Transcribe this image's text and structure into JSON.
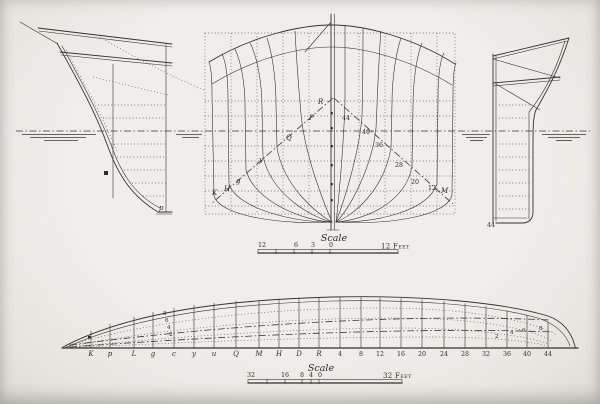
{
  "colors": {
    "paper": "#efeeea",
    "ink": "#35322c"
  },
  "body_plan": {
    "left_labels": [
      "R",
      "P",
      "Q",
      "y",
      "g",
      "H",
      "K"
    ],
    "right_labels": [
      "44",
      "40",
      "36",
      "28",
      "20",
      "12",
      "M"
    ]
  },
  "bow_profile": {
    "station_label": "p"
  },
  "stern_profile": {
    "station_label": "44"
  },
  "scale_top": {
    "title": "Scale",
    "ticks": [
      "12",
      "6",
      "3",
      "0"
    ],
    "unit": "12 Feet"
  },
  "scale_bottom": {
    "title": "Scale",
    "ticks": [
      "32",
      "16",
      "8",
      "4",
      "0"
    ],
    "unit": "32 Feet"
  },
  "half_breadth": {
    "stations": [
      "K",
      "p",
      "L",
      "g",
      "c",
      "y",
      "u",
      "Q",
      "M",
      "H",
      "D",
      "R",
      "4",
      "8",
      "12",
      "16",
      "20",
      "24",
      "28",
      "32",
      "36",
      "40",
      "44"
    ],
    "diagonal_labels": [
      "8",
      "6",
      "4",
      "2"
    ],
    "waterline_labels": [
      "2",
      "4",
      "6",
      "8"
    ]
  }
}
